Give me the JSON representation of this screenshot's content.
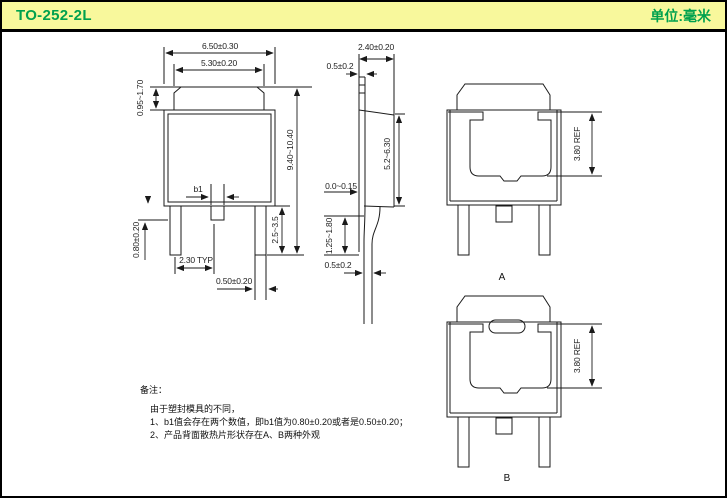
{
  "header": {
    "title": "TO-252-2L",
    "unit_label": "单位:毫米"
  },
  "colors": {
    "header_bg": "#f8f89c",
    "header_text": "#00a14e",
    "line": "#1a1a1a"
  },
  "front_view": {
    "d650": "6.50±0.30",
    "d530": "5.30±0.20",
    "d095": "0.95~1.70",
    "d940": "9.40~10.40",
    "d2535": "2.5~3.5",
    "b1": "b1",
    "d080": "0.80±0.20",
    "d230": "2.30 TYP",
    "d050": "0.50±0.20"
  },
  "side_view": {
    "d240": "2.40±0.20",
    "d05top": "0.5±0.2",
    "d00015": "0.0~0.15",
    "d125": "1.25~1.80",
    "d05bot": "0.5±0.2",
    "d52": "5.2~6.30"
  },
  "rear_view_a": {
    "d380": "3.80 REF",
    "label": "A"
  },
  "rear_view_b": {
    "d380": "3.80 REF",
    "label": "B"
  },
  "notes": {
    "title": "备注：",
    "intro": "由于塑封模具的不同，",
    "item1": "1、b1值会存在两个数值，即b1值为0.80±0.20或者是0.50±0.20；",
    "item2": "2、产品背面散热片形状存在A、B两种外观"
  }
}
